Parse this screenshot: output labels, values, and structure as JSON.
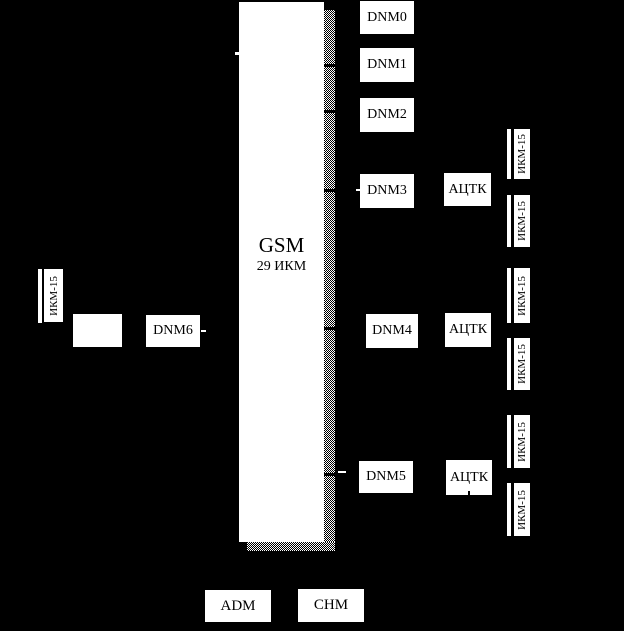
{
  "colors": {
    "background": "#000000",
    "box_fill": "#ffffff",
    "box_text": "#000000"
  },
  "gsm_unit": {
    "title": "GSM",
    "subtitle": "29 ИКМ"
  },
  "dnm_units": [
    {
      "label": "DNM0"
    },
    {
      "label": "DNM1"
    },
    {
      "label": "DNM2"
    },
    {
      "label": "DNM3"
    },
    {
      "label": "DNM4"
    },
    {
      "label": "DNM5"
    },
    {
      "label": "DNM6"
    }
  ],
  "actk_units": [
    {
      "label": "АЦТК"
    },
    {
      "label": "АЦТК"
    },
    {
      "label": "АЦТК"
    }
  ],
  "ikm15_label": "ИКМ-15",
  "adm_label": "ADM",
  "chm_label": "CHM"
}
